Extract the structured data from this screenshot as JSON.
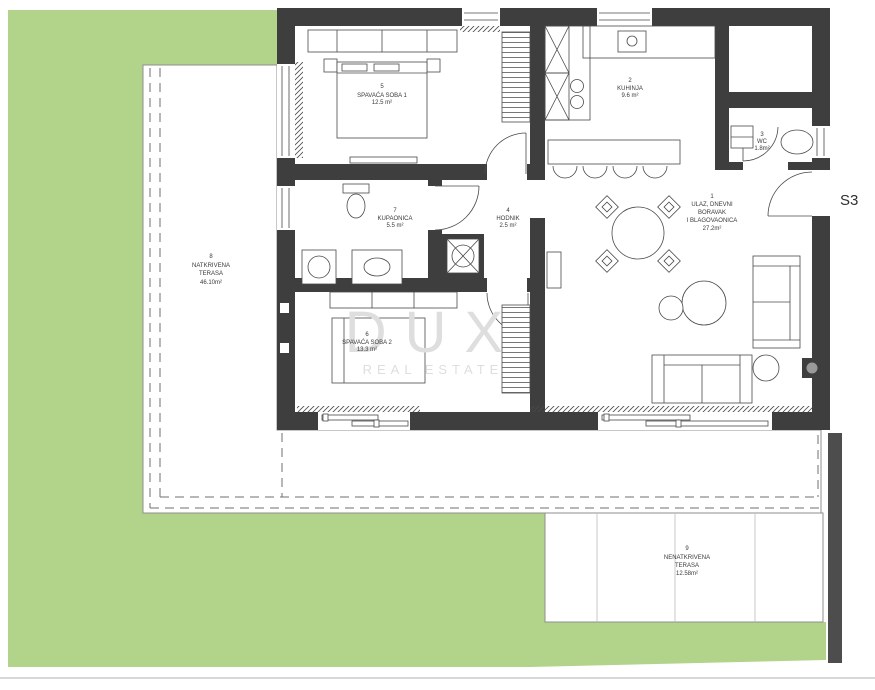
{
  "unit": {
    "label": "S3"
  },
  "watermark": {
    "brand": "DUX",
    "tagline": "REAL ESTATE"
  },
  "colors": {
    "lawn": "#b2d48a",
    "wall": "#3e3e3e",
    "fence": "#4d4d4d",
    "line": "#4a4a4a",
    "dash": "#6f6f6f",
    "terrace_line": "#8f8f8f",
    "divider": "#bdbdbd",
    "label": "#3a3a3a",
    "watermark": "#dedede",
    "border": "#b0b0b0"
  },
  "rooms": {
    "living": {
      "number": "1",
      "lines": [
        "ULAZ, DNEVNI",
        "BORAVAK",
        "I BLAGOVAONICA"
      ],
      "area": "27.2m²"
    },
    "kitchen": {
      "number": "2",
      "name": "KUHINJA",
      "area": "9.6 m²"
    },
    "wc": {
      "number": "3",
      "name": "WC",
      "area": "1.8m²"
    },
    "hallway": {
      "number": "4",
      "name": "HODNIK",
      "area": "2.5 m²"
    },
    "bedroom1": {
      "number": "5",
      "name": "SPAVAĆA SOBA 1",
      "area": "12.5 m²"
    },
    "bedroom2": {
      "number": "6",
      "name": "SPAVAĆA SOBA 2",
      "area": "13.3 m²"
    },
    "bathroom": {
      "number": "7",
      "name": "KUPAONICA",
      "area": "5.5 m²"
    },
    "terrace_covered": {
      "number": "8",
      "lines": [
        "NATKRIVENA",
        "TERASA"
      ],
      "area": "46.10m²"
    },
    "terrace_open": {
      "number": "9",
      "lines": [
        "NENATKRIVENA",
        "TERASA"
      ],
      "area": "12.58m²"
    }
  }
}
